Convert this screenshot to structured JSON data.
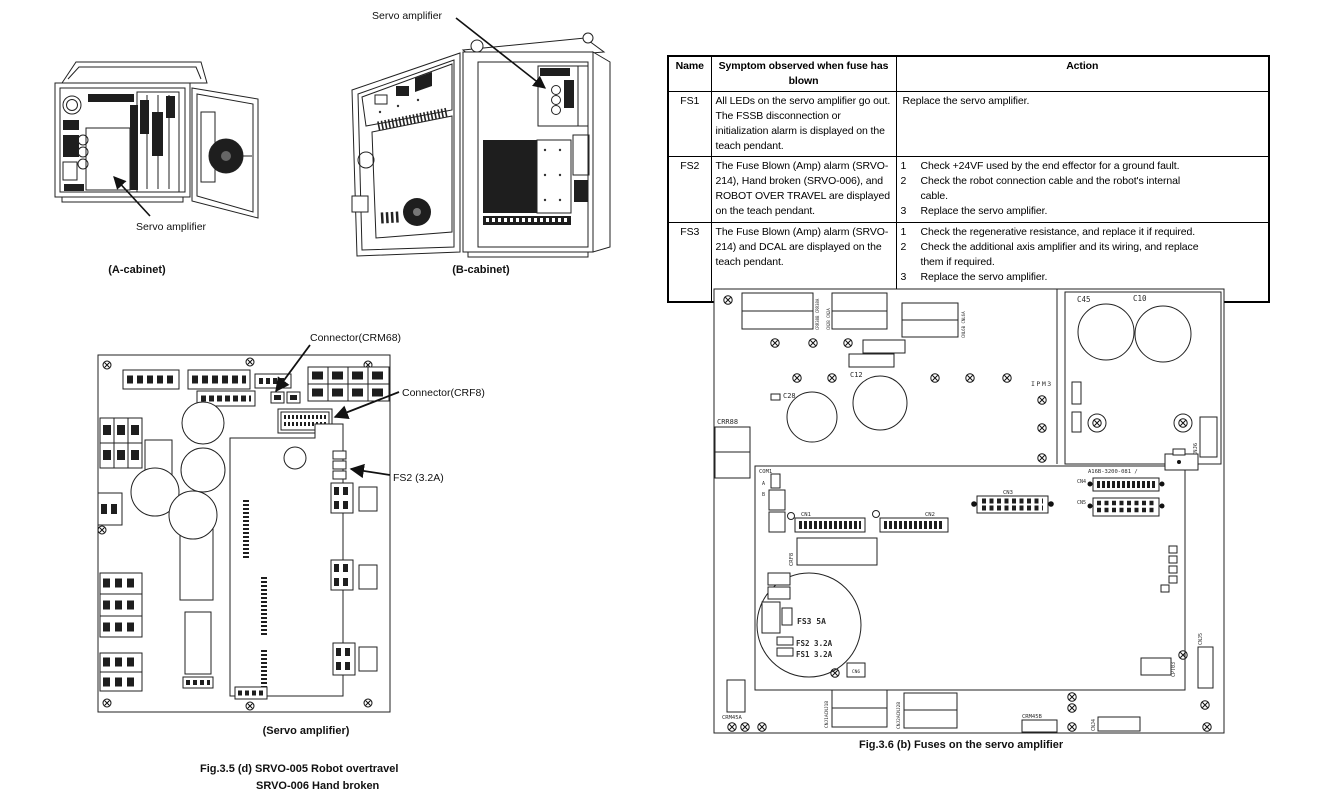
{
  "cabinets": {
    "servo_label_b": "Servo amplifier",
    "servo_label_a": "Servo amplifier",
    "caption_a": "(A-cabinet)",
    "caption_b": "(B-cabinet)"
  },
  "fuse_table": {
    "headers": {
      "name": "Name",
      "symptom": "Symptom observed when fuse has\nblown",
      "action": "Action"
    },
    "rows": [
      {
        "name": "FS1",
        "symptom": "All LEDs on the servo amplifier go out. The FSSB disconnection or initialization alarm is displayed on the teach pendant.",
        "action_plain": "Replace the servo amplifier."
      },
      {
        "name": "FS2",
        "symptom": "The Fuse Blown (Amp) alarm (SRVO-214), Hand broken (SRVO-006), and ROBOT OVER TRAVEL are displayed on the teach pendant.",
        "actions": [
          {
            "n": "1",
            "t": "Check +24VF used by the end effector for a ground fault."
          },
          {
            "n": "2",
            "t": "Check the robot connection cable and the robot's internal cable."
          },
          {
            "n": "3",
            "t": "Replace the servo amplifier."
          }
        ]
      },
      {
        "name": "FS3",
        "symptom": "The Fuse Blown (Amp) alarm (SRVO-214) and DCAL are displayed on the teach pendant.",
        "actions": [
          {
            "n": "1",
            "t": "Check the regenerative resistance, and replace it if required."
          },
          {
            "n": "2",
            "t": "Check the additional axis amplifier and its wiring, and replace them if required."
          },
          {
            "n": "3",
            "t": "Replace the servo amplifier."
          }
        ]
      }
    ]
  },
  "board35": {
    "callout_crm68": "Connector(CRM68)",
    "callout_crf8": "Connector(CRF8)",
    "callout_fs2": "FS2 (3.2A)",
    "caption": "(Servo amplifier)",
    "fig_line1": "Fig.3.5 (d) SRVO-005 Robot overtravel",
    "fig_line2": "SRVO-006 Hand broken"
  },
  "board36": {
    "caption": "Fig.3.6 (b) Fuses on the servo amplifier",
    "crr88": "CRR88",
    "com1": "COM1",
    "com1_a": "A",
    "com1_b": "B",
    "c28": "C28",
    "c12": "C12",
    "c45": "C45",
    "c10": "C10",
    "ipm3": "IPM3",
    "cnj6": "CNJ6",
    "part_no": "A16B-3200-081 /",
    "cn1": "CN1",
    "cn2": "CN2",
    "cn3": "CN3",
    "cn4": "CN4",
    "cn5": "CN5",
    "cn6": "CN6",
    "crf8": "CRF8",
    "fs3": "FS3 5A",
    "fs2": "FS2 3.2A",
    "fs1": "FS1 3.2A",
    "crm45a": "CRM45A",
    "crm45b": "CRM45B",
    "cnj1": "CNJ1ACNJ1B",
    "cnj2": "CNJ2ACNJ2B",
    "cpt03": "CPT03",
    "cnj5": "CNJ5",
    "cnj4": "CNJ4",
    "crr38": "CRR38B CRR38A",
    "cn2ab": "CN2B CN2A",
    "cnl6": "CNL6B CNL6A"
  }
}
